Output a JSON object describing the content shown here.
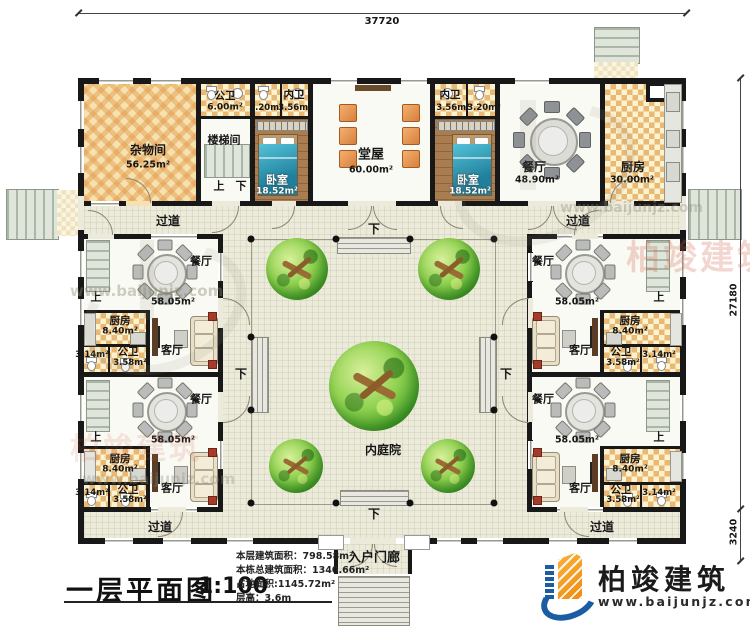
{
  "dims": {
    "top": "37720",
    "right_main": "27180",
    "right_porch": "3240"
  },
  "labels": {
    "up": "上",
    "down": "下",
    "corridor": "过道"
  },
  "rooms": {
    "storage": {
      "name": "杂物间",
      "area": "56.25m²"
    },
    "public_wc": {
      "name": "公卫",
      "area": "6.00m²"
    },
    "stairwell": {
      "name": "楼梯间"
    },
    "inner_wc_left": {
      "name": "内卫",
      "area_a": "3.20m²",
      "area_b": "3.56m²"
    },
    "inner_wc_right": {
      "name": "内卫",
      "area_a": "3.56m²",
      "area_b": "3.20m²"
    },
    "bedroom": {
      "name": "卧室",
      "area": "18.52m²"
    },
    "hall": {
      "name": "堂屋",
      "area": "60.00m²"
    },
    "main_dining": {
      "name": "餐厅",
      "area": "48.90m²"
    },
    "main_kitchen": {
      "name": "厨房",
      "area": "30.00m²"
    },
    "courtyard": {
      "name": "内庭院"
    },
    "porch": {
      "name": "入户门廊"
    }
  },
  "unit": {
    "dining": {
      "name": "餐厅",
      "area": "58.05m²"
    },
    "kitchen": {
      "name": "厨房",
      "area": "8.40m²"
    },
    "wc": {
      "name": "公卫",
      "area": "3.58m²",
      "area_small": "3.14m²"
    },
    "living": {
      "name": "客厅"
    }
  },
  "title_block": {
    "title": "一层平面图",
    "scale": "1:100"
  },
  "stats": {
    "floor_area_label": "本层建筑面积：",
    "floor_area_value": "798.58m²",
    "total_area_label": "本栋总建筑面积：",
    "total_area_value": "1340.66m²",
    "land_area_label": "占地面积:",
    "land_area_value": "1145.72m²",
    "story_height_label": "层高：",
    "story_height_value": "3.6m"
  },
  "brand": {
    "name": "柏竣建筑",
    "website": "www.baijunjz.com"
  },
  "watermark": {
    "brand": "柏竣建筑",
    "site": "www.baijunjz.com"
  }
}
